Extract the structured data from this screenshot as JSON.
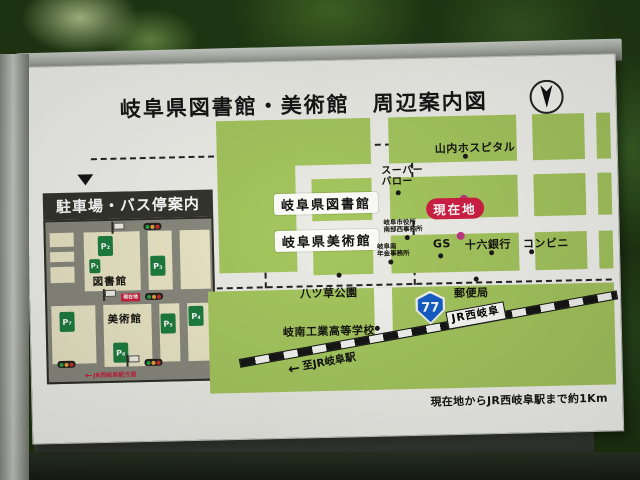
{
  "sign": {
    "title": "岐阜県図書館・美術館　周辺案内図",
    "note": "現在地からJR西岐阜駅まで約1Km"
  },
  "glyphs": {
    "left_arrow": "←"
  },
  "inset": {
    "title": "駐車場・バス停案内",
    "labels": {
      "library": "図書館",
      "museum": "美術館",
      "current": "現在地",
      "direction": "JR西岐阜駅方面"
    },
    "parking": [
      "P₁",
      "P₂",
      "P₃",
      "P₄",
      "P₅",
      "P₆",
      "P₇"
    ]
  },
  "map": {
    "library": "岐阜県図書館",
    "museum": "岐阜県美術館",
    "current_location": "現在地",
    "hospital": "山内ホスピタル",
    "supermarket_line1": "スーパー",
    "supermarket_line2": "バロー",
    "city_office_line1": "岐阜市役所",
    "city_office_line2": "南部西事務所",
    "pension_office_line1": "岐阜南",
    "pension_office_line2": "年金事務所",
    "gas_station": "GS",
    "bank": "十六銀行",
    "convenience": "コンビニ",
    "post_office": "郵便局",
    "park": "八ツ草公園",
    "school": "岐南工業高等学校",
    "route_number": "77",
    "station": "JR西岐阜",
    "to_station": "至JR岐阜駅"
  },
  "colors": {
    "block_green": "#a6c75f",
    "route_blue": "#1660c8",
    "marker_magenta": "#c03a85",
    "current_red": "#d01f45",
    "parking_green": "#1e7e40",
    "inset_cream": "#ece7c7",
    "inset_road_gray": "#8a8a7f"
  }
}
